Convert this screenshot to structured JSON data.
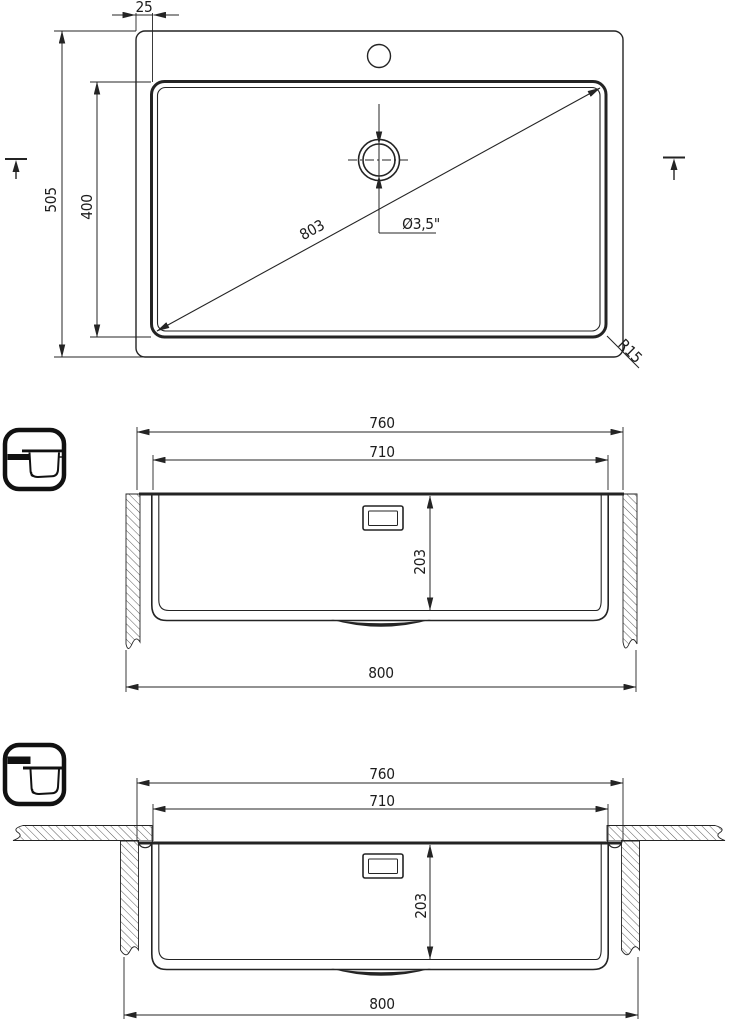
{
  "drawing_title": "sink-installation-technical-drawing",
  "views": {
    "top": {
      "name": "top-view",
      "labels": {
        "rim_width": "25",
        "overall_depth": "505",
        "bowl_depth": "400",
        "diagonal": "803",
        "drain_diameter": "Ø3,5\"",
        "corner_radius": "R15"
      }
    },
    "section_inset": {
      "name": "section-top-mount",
      "labels": {
        "rim_width": "760",
        "bowl_width": "710",
        "bowl_height": "203",
        "overall_width": "800"
      }
    },
    "section_flush": {
      "name": "section-flush-mount",
      "labels": {
        "rim_width": "760",
        "bowl_width": "710",
        "bowl_height": "203",
        "overall_width": "800"
      }
    }
  },
  "icons": [
    {
      "name": "top-mount-icon",
      "meaning": "sink rim mounted on top of countertop"
    },
    {
      "name": "flush-mount-icon",
      "meaning": "sink rim flush with countertop"
    }
  ],
  "colors": {
    "line": "#242424",
    "background": "#ffffff",
    "hatch": "#4a4a4a"
  }
}
